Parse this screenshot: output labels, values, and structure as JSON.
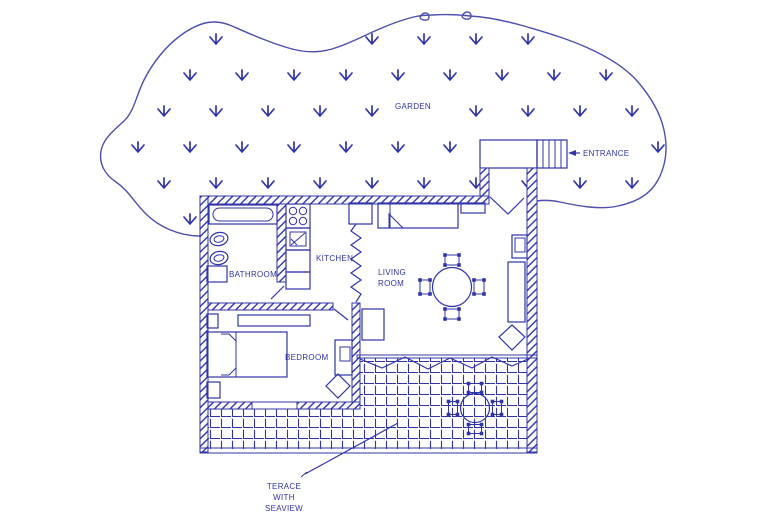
{
  "colors": {
    "ink": "#3034a6",
    "garden_ink": "#4c50ac",
    "background": "#ffffff"
  },
  "labels": {
    "garden": "GARDEN",
    "entrance": "ENTRANCE",
    "bathroom": "BATHROOM",
    "kitchen": "KITCHEN",
    "living_room": [
      "LIVING",
      "ROOM"
    ],
    "bedroom": "BEDROOM",
    "terrace": [
      "TERACE",
      "WITH",
      "SEAVIEW"
    ]
  },
  "plan": {
    "type": "floor-plan",
    "rooms": [
      "GARDEN",
      "BATHROOM",
      "KITCHEN",
      "LIVING ROOM",
      "BEDROOM",
      "TERACE WITH SEAVIEW"
    ],
    "entrance_note": "ENTRANCE"
  }
}
